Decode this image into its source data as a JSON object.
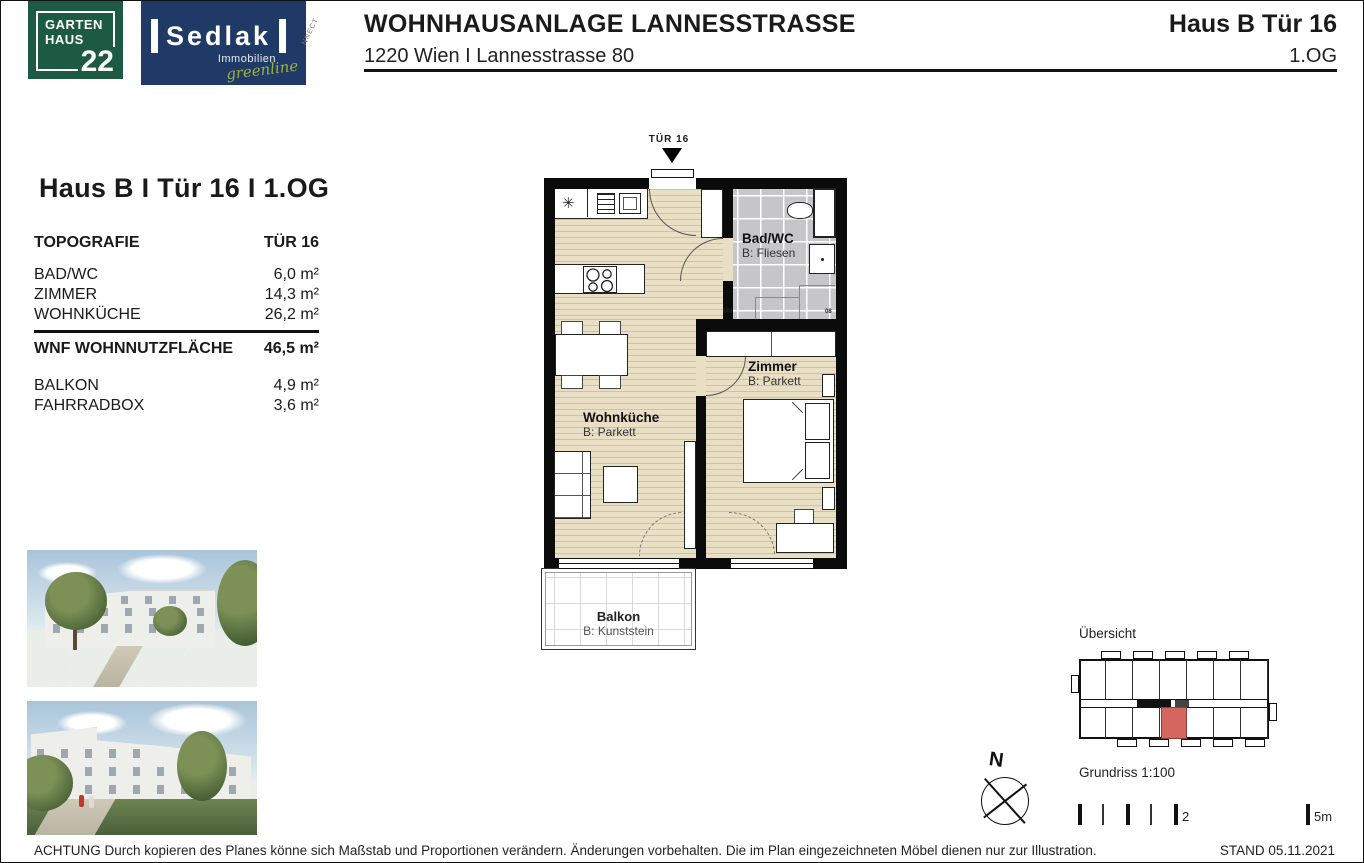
{
  "header": {
    "logo_garten": {
      "line1": "GARTEN",
      "line2": "HAUS",
      "number": "22"
    },
    "logo_sedlak": {
      "name": "Sedlak",
      "sub": "Immobilien",
      "script": "greenline"
    },
    "watermark": "NNECT",
    "title": "WOHNHAUSANLAGE LANNESSTRASSE",
    "subtitle": "1220 Wien I Lannesstrasse 80",
    "unit": "Haus B Tür 16",
    "floor": "1.OG"
  },
  "info_panel": {
    "title": "Haus B I Tür 16 I 1.OG",
    "table": {
      "header": {
        "label": "TOPOGRAFIE",
        "value": "TÜR 16"
      },
      "rows": [
        {
          "label": "BAD/WC",
          "value": "6,0 m²"
        },
        {
          "label": "ZIMMER",
          "value": "14,3 m²"
        },
        {
          "label": "WOHNKÜCHE",
          "value": "26,2 m²"
        }
      ],
      "total": {
        "label": "WNF WOHNNUTZFLÄCHE",
        "value": "46,5 m²"
      },
      "extras": [
        {
          "label": "BALKON",
          "value": "4,9 m²"
        },
        {
          "label": "FAHRRADBOX",
          "value": "3,6 m²"
        }
      ]
    }
  },
  "plan": {
    "entrance_label": "TÜR 16",
    "star_icon": "✳",
    "rooms": {
      "bad": {
        "name": "Bad/WC",
        "floor": "B: Fliesen"
      },
      "zimmer": {
        "name": "Zimmer",
        "floor": "B: Parkett"
      },
      "wohnkueche": {
        "name": "Wohnküche",
        "floor": "B: Parkett"
      },
      "balkon": {
        "name": "Balkon",
        "floor": "B: Kunststein"
      }
    },
    "tiny_marks": {
      "left": "MN",
      "right": "08"
    }
  },
  "legend": {
    "uebersicht_label": "Übersicht",
    "compass_label": "N",
    "scale_label": "Grundriss 1:100",
    "scale_mid": "2",
    "scale_end": "5m"
  },
  "footer": {
    "disclaimer": "ACHTUNG Durch kopieren des Planes könne sich Maßstab und Proportionen verändern. Änderungen vorbehalten. Die im Plan eingezeichneten Möbel dienen nur zur Illustration.",
    "stand": "STAND 05.11.2021"
  },
  "colors": {
    "logo_green": "#1d5a43",
    "logo_navy": "#1f3a66",
    "greenline_green": "#9ab23d",
    "parquet": "#e9dfc4",
    "tile_gray": "#c6c6c8",
    "wall_black": "#0b0b0b",
    "highlight_red": "#d4655f"
  }
}
